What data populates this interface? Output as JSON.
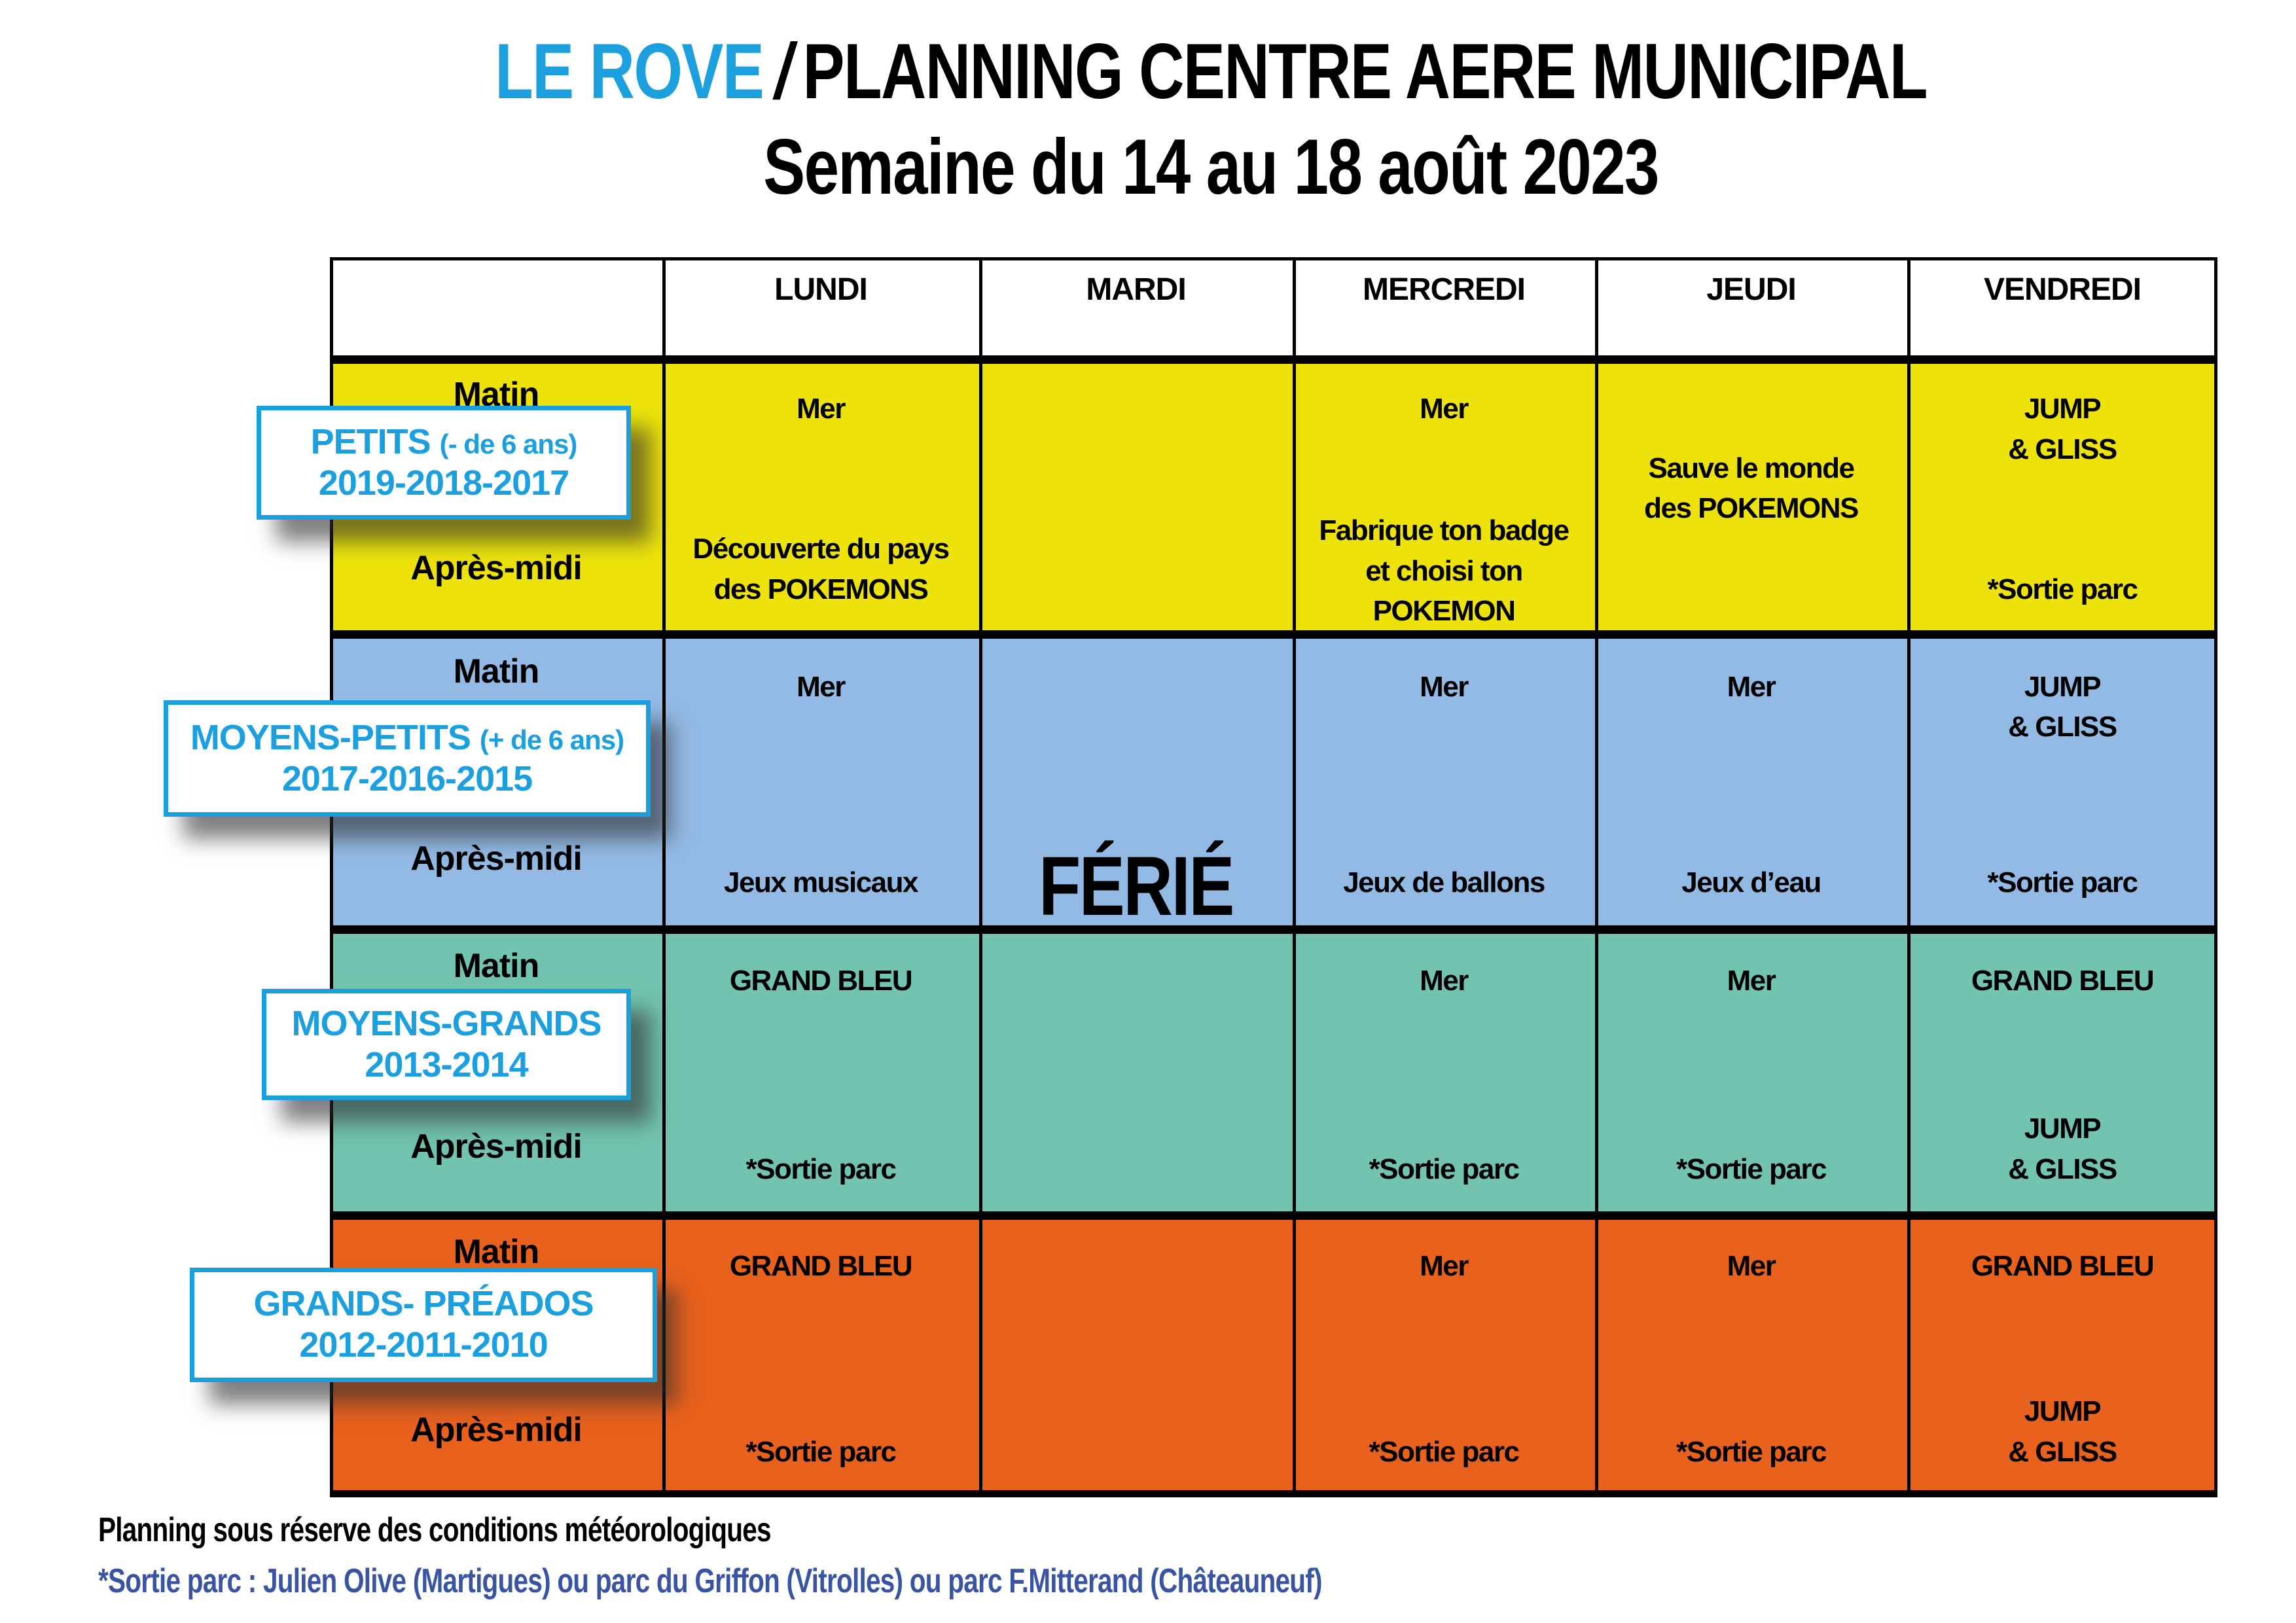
{
  "colors": {
    "accent_blue": "#1C9FDE",
    "footer_blue": "#3A54A4",
    "yellow_row": "#EDE30B",
    "blue_row": "#93BAE5",
    "teal_row": "#72C3AF",
    "orange_row": "#E8611D",
    "grid_black": "#000000"
  },
  "title": {
    "brand": "LE ROVE",
    "slash": "/",
    "main": "PLANNING CENTRE AERE MUNICIPAL",
    "subtitle": "Semaine du 14 au 18 août 2023",
    "brand_color": "#1C9FDE"
  },
  "table": {
    "days": [
      "LUNDI",
      "MARDI",
      "MERCREDI",
      "JEUDI",
      "VENDREDI"
    ],
    "morning_label": "Matin",
    "afternoon_label": "Après-midi",
    "holiday_text": "FÉRIÉ",
    "groups": [
      {
        "name_main": "PETITS",
        "name_note": "(- de 6 ans)",
        "years": "2019-2018-2017",
        "row_color": "#EDE30B",
        "cells": [
          {
            "day": "LUNDI",
            "top": "Mer",
            "middle": "",
            "bottom": "Découverte du pays\ndes POKEMONS"
          },
          {
            "day": "MARDI",
            "top": "",
            "middle": "",
            "bottom": ""
          },
          {
            "day": "MERCREDI",
            "top": "Mer",
            "middle": "",
            "bottom": "Fabrique ton badge\net choisi ton\nPOKEMON"
          },
          {
            "day": "JEUDI",
            "top": "",
            "middle": "Sauve le monde\ndes POKEMONS",
            "bottom": ""
          },
          {
            "day": "VENDREDI",
            "top": "JUMP\n& GLISS",
            "middle": "",
            "bottom": "*Sortie parc"
          }
        ]
      },
      {
        "name_main": "MOYENS-PETITS",
        "name_note": "(+ de 6 ans)",
        "years": "2017-2016-2015",
        "row_color": "#93BAE5",
        "cells": [
          {
            "day": "LUNDI",
            "top": "Mer",
            "middle": "",
            "bottom": "Jeux musicaux"
          },
          {
            "day": "MARDI",
            "top": "",
            "middle": "",
            "bottom": "",
            "holiday": true
          },
          {
            "day": "MERCREDI",
            "top": "Mer",
            "middle": "",
            "bottom": "Jeux de ballons"
          },
          {
            "day": "JEUDI",
            "top": "Mer",
            "middle": "",
            "bottom": "Jeux d’eau"
          },
          {
            "day": "VENDREDI",
            "top": "JUMP\n& GLISS",
            "middle": "",
            "bottom": "*Sortie parc"
          }
        ]
      },
      {
        "name_main": "MOYENS-GRANDS",
        "name_note": "",
        "years": "2013-2014",
        "row_color": "#72C3AF",
        "cells": [
          {
            "day": "LUNDI",
            "top": "GRAND BLEU",
            "middle": "",
            "bottom": "*Sortie parc"
          },
          {
            "day": "MARDI",
            "top": "",
            "middle": "",
            "bottom": ""
          },
          {
            "day": "MERCREDI",
            "top": "Mer",
            "middle": "",
            "bottom": "*Sortie parc"
          },
          {
            "day": "JEUDI",
            "top": "Mer",
            "middle": "",
            "bottom": "*Sortie parc"
          },
          {
            "day": "VENDREDI",
            "top": "GRAND BLEU",
            "middle": "",
            "bottom": "JUMP\n& GLISS"
          }
        ]
      },
      {
        "name_main": "GRANDS- PRÉADOS",
        "name_note": "",
        "years": "2012-2011-2010",
        "row_color": "#E8611D",
        "cells": [
          {
            "day": "LUNDI",
            "top": "GRAND BLEU",
            "middle": "",
            "bottom": "*Sortie parc"
          },
          {
            "day": "MARDI",
            "top": "",
            "middle": "",
            "bottom": ""
          },
          {
            "day": "MERCREDI",
            "top": "Mer",
            "middle": "",
            "bottom": "*Sortie parc"
          },
          {
            "day": "JEUDI",
            "top": "Mer",
            "middle": "",
            "bottom": "*Sortie parc"
          },
          {
            "day": "VENDREDI",
            "top": "GRAND BLEU",
            "middle": "",
            "bottom": "JUMP\n& GLISS"
          }
        ]
      }
    ]
  },
  "footer": {
    "line1": "Planning sous réserve des conditions météorologiques",
    "line2": "*Sortie parc : Julien Olive (Martigues) ou parc du Griffon (Vitrolles) ou parc F.Mitterand (Châteauneuf)",
    "line2_color": "#3A54A4"
  }
}
